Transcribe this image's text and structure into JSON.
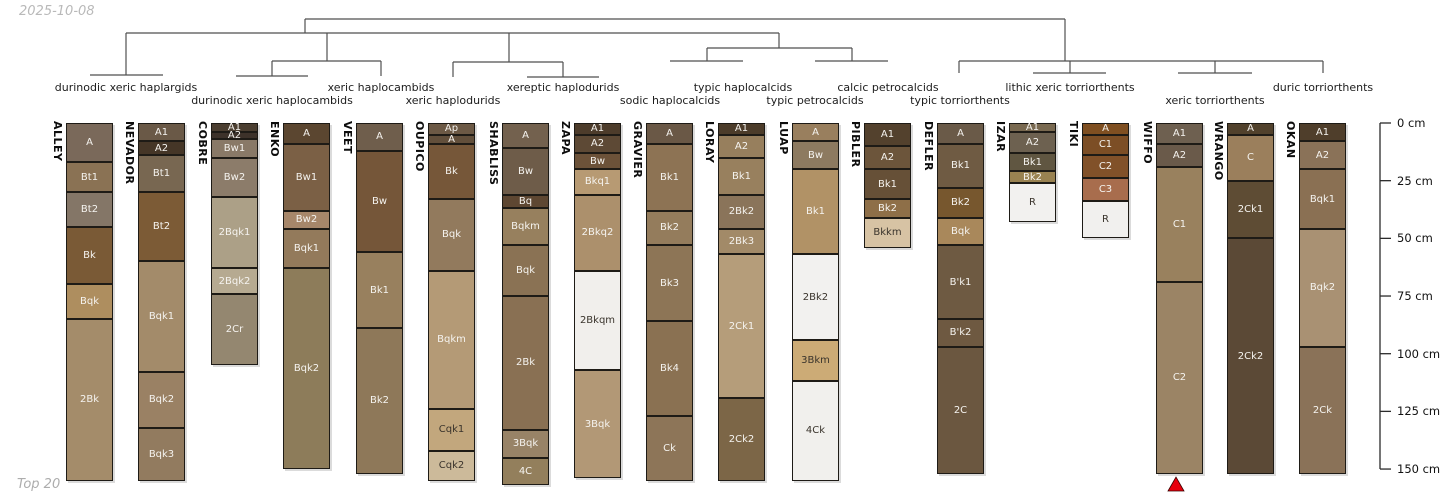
{
  "title_date": "2025-10-08",
  "footer": "Top 20",
  "colors": {
    "background": "#ffffff",
    "dendrogram_line": "#4f4f4f",
    "axis_line": "#2b2b2b",
    "horizon_border": "#1e1b16",
    "label_on_dark": "#f5f3ef",
    "label_on_light": "#3a342c",
    "muted_text": "#b0b0b0",
    "marker_red": "#e8000d"
  },
  "chart_data": {
    "type": "bar",
    "subtype": "soil-profile-columns-with-dendrogram",
    "title": "",
    "depth_axis": {
      "unit": "cm",
      "min": 0,
      "max": 150,
      "tick_interval": 25,
      "ticks": [
        {
          "depth": 0,
          "label": "0 cm"
        },
        {
          "depth": 25,
          "label": "25 cm"
        },
        {
          "depth": 50,
          "label": "50 cm"
        },
        {
          "depth": 75,
          "label": "75 cm"
        },
        {
          "depth": 100,
          "label": "100 cm"
        },
        {
          "depth": 125,
          "label": "125 cm"
        },
        {
          "depth": 150,
          "label": "150 cm"
        }
      ]
    },
    "dendrogram": {
      "taxa": [
        {
          "label": "durinodic xeric haplargids",
          "x": 126,
          "row": 1,
          "leaves": [
            "ALLEY",
            "NEVADOR"
          ]
        },
        {
          "label": "durinodic xeric haplocambids",
          "x": 272,
          "row": 2,
          "leaves": [
            "COBRE",
            "ENKO"
          ]
        },
        {
          "label": "xeric haplocambids",
          "x": 381,
          "row": 1,
          "leaves": [
            "VEET"
          ]
        },
        {
          "label": "xeric haplodurids",
          "x": 453,
          "row": 2,
          "leaves": [
            "OUPICO"
          ]
        },
        {
          "label": "xereptic haplodurids",
          "x": 563,
          "row": 1,
          "leaves": [
            "SHABLISS",
            "ZAPA"
          ]
        },
        {
          "label": "sodic haplocalcids",
          "x": 670,
          "row": 2,
          "leaves": [
            "GRAVIER"
          ]
        },
        {
          "label": "typic haplocalcids",
          "x": 743,
          "row": 1,
          "leaves": [
            "LORAY"
          ]
        },
        {
          "label": "typic petrocalcids",
          "x": 815,
          "row": 2,
          "leaves": [
            "LUAP"
          ]
        },
        {
          "label": "calcic petrocalcids",
          "x": 888,
          "row": 1,
          "leaves": [
            "PIBLER"
          ]
        },
        {
          "label": "typic torriorthents",
          "x": 960,
          "row": 2,
          "leaves": [
            "DEFLER"
          ]
        },
        {
          "label": "lithic xeric torriorthents",
          "x": 1070,
          "row": 1,
          "leaves": [
            "IZAR",
            "TIKI"
          ]
        },
        {
          "label": "xeric torriorthents",
          "x": 1215,
          "row": 2,
          "leaves": [
            "WIFFO",
            "WRANGO"
          ]
        },
        {
          "label": "duric torriorthents",
          "x": 1323,
          "row": 1,
          "leaves": [
            "OKAN"
          ]
        }
      ],
      "segments": [
        [
          305,
          19,
          1065,
          19
        ],
        [
          305,
          19,
          305,
          33
        ],
        [
          1065,
          19,
          1065,
          61
        ],
        [
          126,
          33,
          779,
          33
        ],
        [
          126,
          33,
          126,
          75
        ],
        [
          90,
          75,
          163,
          75
        ],
        [
          327,
          33,
          327,
          61
        ],
        [
          272,
          61,
          381,
          61
        ],
        [
          272,
          61,
          272,
          76
        ],
        [
          236,
          76,
          308,
          76
        ],
        [
          381,
          61,
          381,
          76
        ],
        [
          509,
          33,
          509,
          62
        ],
        [
          453,
          62,
          563,
          62
        ],
        [
          453,
          62,
          453,
          77
        ],
        [
          563,
          62,
          563,
          77
        ],
        [
          527,
          77,
          599,
          77
        ],
        [
          779,
          33,
          779,
          48
        ],
        [
          707,
          48,
          852,
          48
        ],
        [
          707,
          48,
          707,
          61
        ],
        [
          670,
          61,
          743,
          61
        ],
        [
          852,
          48,
          852,
          61
        ],
        [
          815,
          61,
          888,
          61
        ],
        [
          959,
          61,
          1323,
          61
        ],
        [
          959,
          61,
          959,
          73
        ],
        [
          1070,
          61,
          1070,
          73
        ],
        [
          1033,
          73,
          1106,
          73
        ],
        [
          1215,
          61,
          1215,
          73
        ],
        [
          1178,
          73,
          1252,
          73
        ],
        [
          1323,
          61,
          1323,
          73
        ]
      ]
    },
    "horizon_fields": [
      "name",
      "top_cm",
      "bottom_cm",
      "color",
      "text"
    ],
    "profiles": [
      {
        "name": "ALLEY",
        "x": 66,
        "horizons": [
          [
            "A",
            17,
            "#7a695a"
          ],
          [
            "Bt1",
            30,
            "#8a7254"
          ],
          [
            "Bt2",
            45,
            "#847667"
          ],
          [
            "Bk",
            70,
            "#7a5a36"
          ],
          [
            "Bqk",
            85,
            "#ae8e5f"
          ],
          [
            "2Bk",
            155,
            "#a48c6a"
          ]
        ]
      },
      {
        "name": "NEVADOR",
        "x": 138,
        "horizons": [
          [
            "A1",
            8,
            "#6a5947"
          ],
          [
            "A2",
            14,
            "#453627"
          ],
          [
            "Bt1",
            30,
            "#786751"
          ],
          [
            "Bt2",
            60,
            "#7c5b36"
          ],
          [
            "Bqk1",
            108,
            "#a38b6a"
          ],
          [
            "Bqk2",
            132,
            "#9a8164"
          ],
          [
            "Bqk3",
            155,
            "#927b5f"
          ]
        ]
      },
      {
        "name": "COBRE",
        "x": 211,
        "horizons": [
          [
            "A1",
            4,
            "#4b3e30"
          ],
          [
            "A2",
            7,
            "#3d322a"
          ],
          [
            "Bw1",
            15,
            "#897967"
          ],
          [
            "Bw2",
            32,
            "#8c7c6a"
          ],
          [
            "2Bqk1",
            63,
            "#aca087"
          ],
          [
            "2Bqk2",
            74,
            "#b6aa91"
          ],
          [
            "2Cr",
            105,
            "#948770"
          ]
        ]
      },
      {
        "name": "ENKO",
        "x": 283,
        "horizons": [
          [
            "A",
            9,
            "#5b4630"
          ],
          [
            "Bw1",
            38,
            "#7b6045"
          ],
          [
            "Bw2",
            46,
            "#a7876a"
          ],
          [
            "Bqk1",
            63,
            "#937a5b"
          ],
          [
            "Bqk2",
            150,
            "#8d7c5a"
          ]
        ]
      },
      {
        "name": "VEET",
        "x": 356,
        "horizons": [
          [
            "A",
            12,
            "#6f5e4c"
          ],
          [
            "Bw",
            56,
            "#755639"
          ],
          [
            "Bk1",
            89,
            "#98805e"
          ],
          [
            "Bk2",
            152,
            "#8e7859"
          ]
        ]
      },
      {
        "name": "OUPICO",
        "x": 428,
        "horizons": [
          [
            "Ap",
            5,
            "#6c5945"
          ],
          [
            "A",
            9,
            "#624f3b"
          ],
          [
            "Bk",
            33,
            "#765739"
          ],
          [
            "Bqk",
            64,
            "#927a5d"
          ],
          [
            "Bqkm",
            124,
            "#b49a76"
          ],
          [
            "Cqk1",
            142,
            "#c2a77d",
            "dark"
          ],
          [
            "Cqk2",
            155,
            "#ccba9a",
            "dark"
          ]
        ]
      },
      {
        "name": "SHABLISS",
        "x": 502,
        "horizons": [
          [
            "A",
            11,
            "#73614e"
          ],
          [
            "Bw",
            31,
            "#6e5c49"
          ],
          [
            "Bq",
            37,
            "#5e4732"
          ],
          [
            "Bqkm",
            53,
            "#97805e"
          ],
          [
            "Bqk",
            75,
            "#8a7254"
          ],
          [
            "2Bk",
            133,
            "#897053"
          ],
          [
            "3Bqk",
            145,
            "#988367"
          ],
          [
            "4C",
            157,
            "#937f5c"
          ]
        ]
      },
      {
        "name": "ZAPA",
        "x": 574,
        "horizons": [
          [
            "A1",
            5,
            "#4d3c2b"
          ],
          [
            "A2",
            13,
            "#5d4935"
          ],
          [
            "Bw",
            20,
            "#6c5239"
          ],
          [
            "Bkq1",
            31,
            "#b79a73"
          ],
          [
            "2Bkq2",
            64,
            "#ac906c"
          ],
          [
            "2Bkqm",
            107,
            "#f1efec",
            "dark"
          ],
          [
            "3Bqk",
            154,
            "#b29876"
          ]
        ]
      },
      {
        "name": "GRAVIER",
        "x": 646,
        "horizons": [
          [
            "A",
            9,
            "#6a5846"
          ],
          [
            "Bk1",
            38,
            "#8d7354"
          ],
          [
            "Bk2",
            53,
            "#947c5c"
          ],
          [
            "Bk3",
            86,
            "#8d7556"
          ],
          [
            "Bk4",
            127,
            "#8a7152"
          ],
          [
            "Ck",
            155,
            "#8d7558"
          ]
        ]
      },
      {
        "name": "LORAY",
        "x": 718,
        "horizons": [
          [
            "A1",
            5,
            "#4c3c2a"
          ],
          [
            "A2",
            15,
            "#977f5d"
          ],
          [
            "Bk1",
            31,
            "#98805e"
          ],
          [
            "2Bk2",
            46,
            "#8a745a"
          ],
          [
            "2Bk3",
            57,
            "#a28a68"
          ],
          [
            "2Ck1",
            119,
            "#b59d7a"
          ],
          [
            "2Ck2",
            155,
            "#7c6647"
          ]
        ]
      },
      {
        "name": "LUAP",
        "x": 792,
        "horizons": [
          [
            "A",
            8,
            "#997f5e"
          ],
          [
            "Bw",
            20,
            "#8d7a60"
          ],
          [
            "Bk1",
            57,
            "#b19266"
          ],
          [
            "2Bk2",
            94,
            "#f2f1ef",
            "dark"
          ],
          [
            "3Bkm",
            112,
            "#ccab76",
            "dark"
          ],
          [
            "4Ck",
            155,
            "#f1f0ed",
            "dark"
          ]
        ]
      },
      {
        "name": "PIBLER",
        "x": 864,
        "horizons": [
          [
            "A1",
            10,
            "#53412d"
          ],
          [
            "A2",
            20,
            "#6c553b"
          ],
          [
            "Bk1",
            33,
            "#665037"
          ],
          [
            "Bk2",
            41,
            "#8e6f48"
          ],
          [
            "Bkkm",
            54,
            "#d7c3a4",
            "dark"
          ]
        ]
      },
      {
        "name": "DEFLER",
        "x": 937,
        "horizons": [
          [
            "A",
            9,
            "#6a5a48"
          ],
          [
            "Bk1",
            28,
            "#6f5b43"
          ],
          [
            "Bk2",
            41,
            "#77572e"
          ],
          [
            "Bqk",
            53,
            "#a9885b"
          ],
          [
            "B'k1",
            85,
            "#6e5a42"
          ],
          [
            "B'k2",
            97,
            "#6e5941"
          ],
          [
            "2C",
            152,
            "#6b5740"
          ]
        ]
      },
      {
        "name": "IZAR",
        "x": 1009,
        "horizons": [
          [
            "A1",
            4,
            "#796950"
          ],
          [
            "A2",
            13,
            "#6d6150"
          ],
          [
            "Bk1",
            21,
            "#605641"
          ],
          [
            "Bk2",
            26,
            "#998251"
          ],
          [
            "R",
            43,
            "#f2f1ef",
            "dark"
          ]
        ]
      },
      {
        "name": "TIKI",
        "x": 1082,
        "horizons": [
          [
            "A",
            5,
            "#7f4f21"
          ],
          [
            "C1",
            14,
            "#7c4e25"
          ],
          [
            "C2",
            24,
            "#815129"
          ],
          [
            "C3",
            34,
            "#a86d4d"
          ],
          [
            "R",
            50,
            "#f1f0ee",
            "dark"
          ]
        ]
      },
      {
        "name": "WIFFO",
        "x": 1156,
        "horizons": [
          [
            "A1",
            9,
            "#6e6050"
          ],
          [
            "A2",
            19,
            "#6a5a4a"
          ],
          [
            "C1",
            69,
            "#99815e"
          ],
          [
            "C2",
            152,
            "#9b8465"
          ]
        ]
      },
      {
        "name": "WRANGO",
        "x": 1227,
        "horizons": [
          [
            "A",
            5,
            "#51412c"
          ],
          [
            "C",
            25,
            "#9b7f5c"
          ],
          [
            "2Ck1",
            50,
            "#5e4c34"
          ],
          [
            "2Ck2",
            152,
            "#5b4936"
          ]
        ]
      },
      {
        "name": "OKAN",
        "x": 1299,
        "horizons": [
          [
            "A1",
            8,
            "#4f3e2b"
          ],
          [
            "A2",
            20,
            "#8a7258"
          ],
          [
            "Bqk1",
            46,
            "#8a7053"
          ],
          [
            "Bqk2",
            97,
            "#a99173"
          ],
          [
            "2Ck",
            152,
            "#8a7258"
          ]
        ]
      }
    ],
    "marker": {
      "profile": "WIFFO",
      "shape": "triangle-up",
      "color": "#e8000d",
      "x": 1176,
      "apex_y": 477,
      "base_y": 491,
      "half_width": 8
    },
    "layout": {
      "top_px": 123,
      "px_per_cm": 2.307,
      "col_width": 47,
      "axis_x": 1380,
      "tick_len": 11,
      "tick_label_x": 1397,
      "taxa_row1_y": 81,
      "taxa_row2_y": 94,
      "name_offset": 15,
      "legend_position": "none",
      "grid": false
    }
  }
}
